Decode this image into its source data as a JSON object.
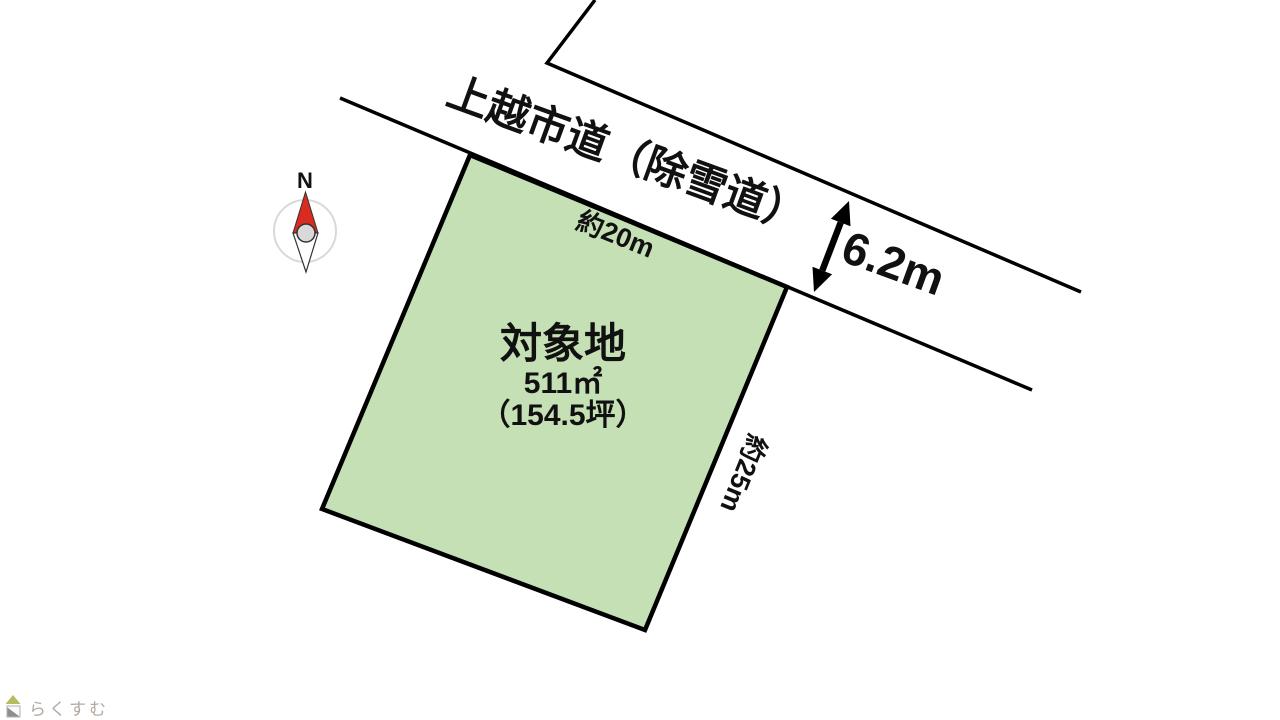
{
  "page": {
    "background": "#ffffff"
  },
  "road": {
    "name": "上越市道（除雪道）",
    "width_label": "6.2m",
    "line_color": "#000000"
  },
  "plot": {
    "title": "対象地",
    "area_m2": "511㎡",
    "area_tsubo": "（154.5坪）",
    "top_edge_label": "約20m",
    "right_edge_label": "約25m",
    "fill_color": "#c5e0b4",
    "outline_color": "#000000"
  },
  "compass": {
    "north_label": "N",
    "needle_color": "#d92b1f"
  },
  "footer": {
    "logo_text": "らくすむ"
  }
}
